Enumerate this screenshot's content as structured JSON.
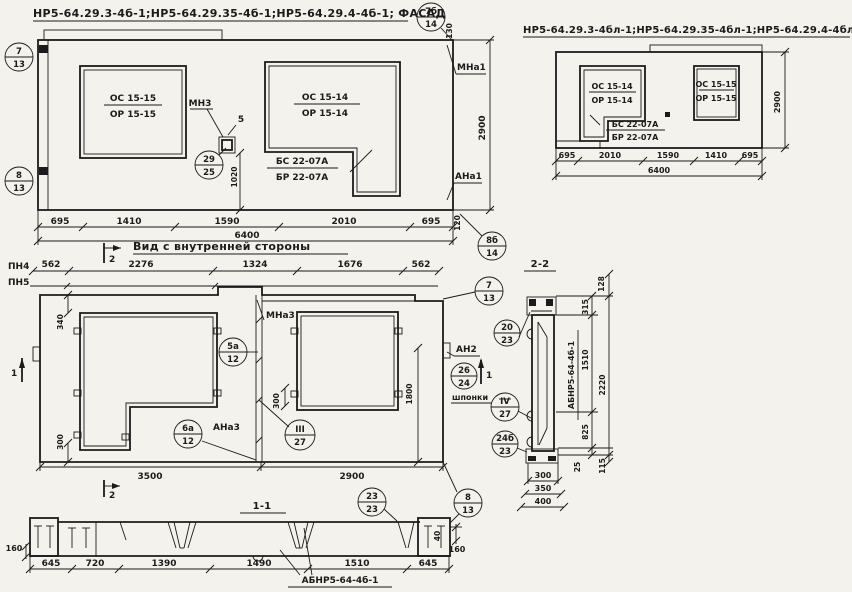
{
  "facade_left": {
    "title": "НР5-64.29.3-4б-1;НР5-64.29.35-4б-1;НР5-64.29.4-4б-1; ФАСАД",
    "win1_top": "ОС 15-15",
    "win1_bot": "ОР 15-15",
    "win2_top": "ОС 15-14",
    "win2_bot": "ОР 15-14",
    "sill_top": "БС 22-07А",
    "sill_bot": "БР 22-07А",
    "mn3": "МН3",
    "five": "5",
    "mna1": "МНа1",
    "ana1": "АНа1",
    "dim_130": "130",
    "dim_2900": "2900",
    "dim_1020": "1020",
    "dim_120": "120",
    "dims_w": [
      "695",
      "1410",
      "1590",
      "2010",
      "695"
    ],
    "dim_total": "6400"
  },
  "facade_right": {
    "title": "НР5-64.29.3-4бл-1;НР5-64.29.35-4бл-1;НР5-64.29.4-4бл-1.ФАСАД",
    "win1_top": "ОС 15-14",
    "win1_bot": "ОР 15-14",
    "sill_top": "БС 22-07А",
    "sill_bot": "БР 22-07А",
    "win2_top": "ОС 15-15",
    "win2_bot": "ОР 15-15",
    "dims_w": [
      "695",
      "2010",
      "1590",
      "1410",
      "695"
    ],
    "dim_total": "6400",
    "dim_h": "2900"
  },
  "inner": {
    "title": "Вид с внутренней стороны",
    "pn4": "ПН4",
    "pn5": "ПН5",
    "mna3": "МНа3",
    "ana3": "АНа3",
    "an2": "АН2",
    "shponki": "шпонки",
    "sec1": "1",
    "sec2": "2",
    "dims_top": [
      "562",
      "2276",
      "1324",
      "1676",
      "562"
    ],
    "dim_340": "340",
    "dim_300l": "300",
    "dim_300r": "300",
    "dim_1800": "1800",
    "dim_3500": "3500",
    "dim_2900": "2900"
  },
  "section1": {
    "title": "1-1",
    "label": "АБНР5-64-4б-1",
    "dims": [
      "645",
      "720",
      "1390",
      "1490",
      "1510",
      "645"
    ],
    "dim_160l": "160",
    "dim_160r": "160",
    "dim_40": "40"
  },
  "section2": {
    "title": "2-2",
    "label": "АБНР5-64-4б-1",
    "dim_128": "128",
    "dim_315": "315",
    "dim_1510": "1510",
    "dim_2220": "2220",
    "dim_825": "825",
    "dim_25": "25",
    "dim_115": "115",
    "dims_bot": [
      "300",
      "350",
      "400"
    ]
  },
  "callouts": {
    "c7_13": {
      "t": "7",
      "b": "13"
    },
    "c8_13": {
      "t": "8",
      "b": "13"
    },
    "c7b_14": {
      "t": "7б",
      "b": "14"
    },
    "c8b_14": {
      "t": "8б",
      "b": "14"
    },
    "c29_25": {
      "t": "29",
      "b": "25"
    },
    "c5a_12": {
      "t": "5а",
      "b": "12"
    },
    "c6a_12": {
      "t": "6а",
      "b": "12"
    },
    "c3_27": {
      "t": "III",
      "b": "27"
    },
    "c26_24": {
      "t": "26",
      "b": "24"
    },
    "c20_23": {
      "t": "20",
      "b": "23"
    },
    "c4_27": {
      "t": "IV",
      "b": "27"
    },
    "c24b_23": {
      "t": "24б",
      "b": "23"
    },
    "c23_23": {
      "t": "23",
      "b": "23"
    }
  }
}
